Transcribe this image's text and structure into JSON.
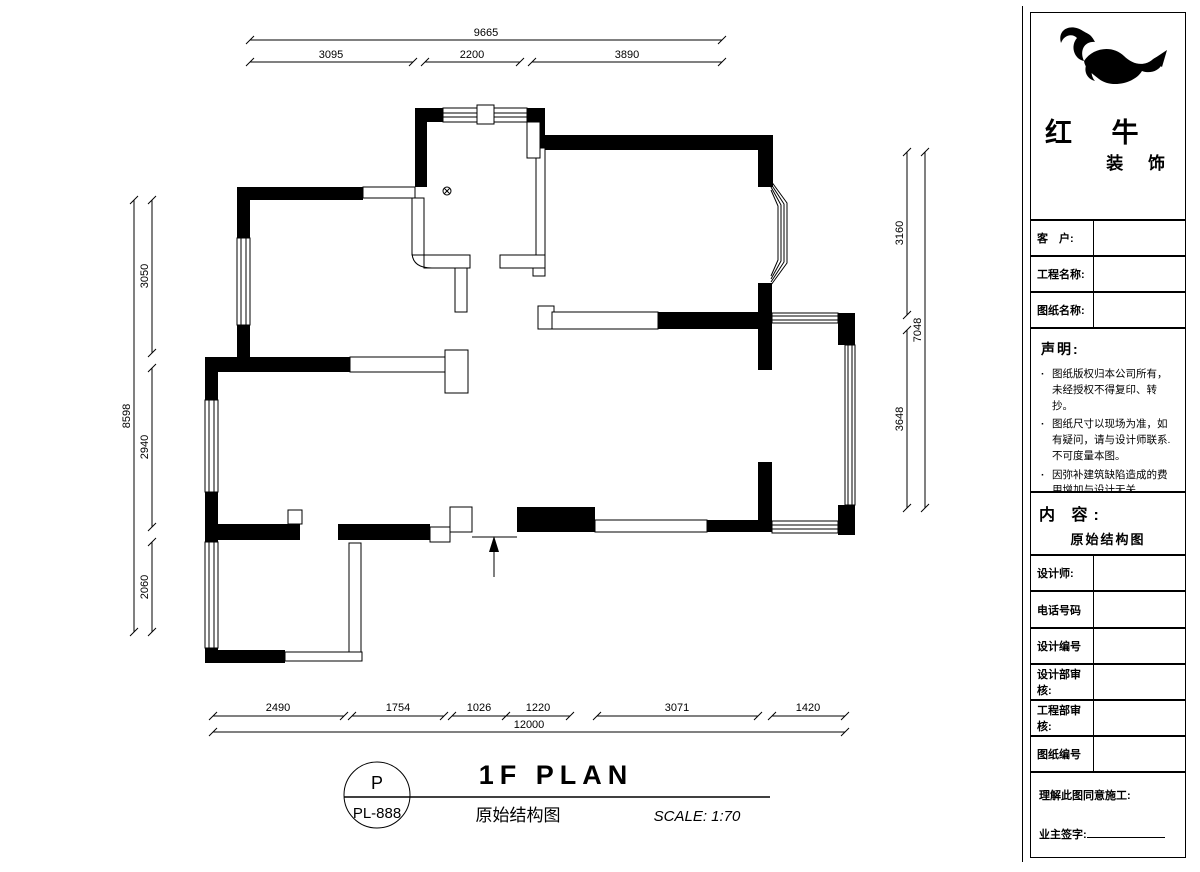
{
  "dims": {
    "top_total": "9665",
    "top_segments": [
      "3095",
      "2200",
      "3890"
    ],
    "left_total": "8598",
    "left_segments": [
      "3050",
      "2940",
      "2060"
    ],
    "right_total": "7048",
    "right_segments": [
      "3160",
      "3648"
    ],
    "bottom_total": "12000",
    "bottom_segments": [
      "2490",
      "1754",
      "1026",
      "1220",
      "3071",
      "1420"
    ]
  },
  "title_block": {
    "ref_letter": "P",
    "ref_code": "PL-888",
    "title": "1F PLAN",
    "subtitle": "原始结构图",
    "scale": "SCALE: 1:70"
  },
  "sidebar": {
    "brand": {
      "line1": "红 牛",
      "line2": "装 饰"
    },
    "rows": [
      {
        "label": "客　户:"
      },
      {
        "label": "工程名称:"
      },
      {
        "label": "图纸名称:"
      }
    ],
    "notice": {
      "title": "声明:",
      "items": [
        "图纸版权归本公司所有，未经授权不得复印、转抄。",
        "图纸尺寸以现场为准，如有疑问，请与设计师联系.不可度量本图。",
        "因弥补建筑缺陷造成的费用增加与设计无关。"
      ]
    },
    "content": {
      "title": "内 容:",
      "value": "原始结构图"
    },
    "info_rows": [
      {
        "label": "设计师:"
      },
      {
        "label": "电话号码"
      },
      {
        "label": "设计编号"
      },
      {
        "label": "设计部审核:"
      },
      {
        "label": "工程部审核:"
      },
      {
        "label": "图纸编号"
      }
    ],
    "footer": {
      "line1": "理解此图同意施工:",
      "line2": "业主签字:"
    }
  },
  "colors": {
    "line": "#000000",
    "paper": "#ffffff"
  }
}
